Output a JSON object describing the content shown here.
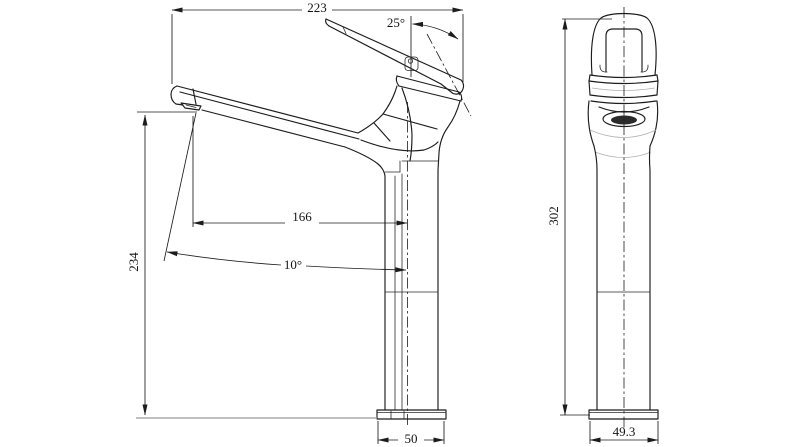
{
  "colors": {
    "background": "#ffffff",
    "line": "#1c1c1c",
    "dimension_text": "#141414",
    "ground_line": "#9a9a9a",
    "construction": "#b0b0b0",
    "aerator_fill": "#2b2b2b"
  },
  "side_view": {
    "dims": {
      "overall_width": "223",
      "handle_angle": "25°",
      "spout_reach": "166",
      "spout_height": "234",
      "stream_angle": "10°",
      "base_width": "50"
    }
  },
  "front_view": {
    "dims": {
      "overall_height": "302",
      "base_width": "49.3"
    }
  }
}
